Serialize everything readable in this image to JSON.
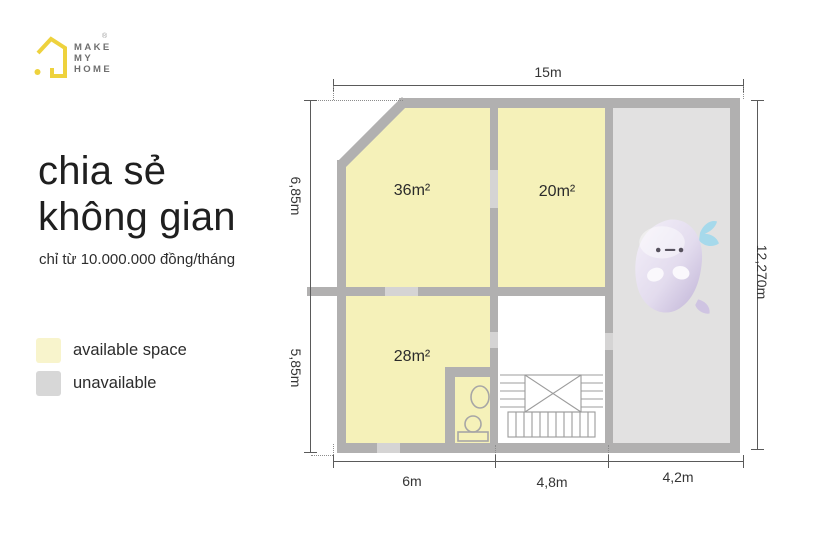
{
  "logo": {
    "lines": [
      "MAKE",
      "MY",
      "HOME"
    ],
    "registered": "®",
    "brand_yellow": "#eed23d"
  },
  "headline": {
    "line1": "chia sẻ",
    "line2": "không gian",
    "subtitle": "chỉ từ 10.000.000 đồng/tháng"
  },
  "legend": {
    "items": [
      {
        "label": "available space",
        "color": "#f8f4cc"
      },
      {
        "label": "unavailable",
        "color": "#d7d7d7"
      }
    ]
  },
  "floorplan": {
    "rooms": [
      {
        "id": "room-36",
        "area_label": "36m²",
        "status": "available"
      },
      {
        "id": "room-20",
        "area_label": "20m²",
        "status": "available"
      },
      {
        "id": "room-28",
        "area_label": "28m²",
        "status": "available"
      }
    ],
    "dimensions": {
      "top": "15m",
      "right": "12,270m",
      "left_upper": "6,85m",
      "left_lower": "5,85m",
      "bottom": [
        "6m",
        "4,8m",
        "4,2m"
      ]
    },
    "colors": {
      "available_fill": "#f5f1b9",
      "unavailable_fill": "#e2e1e1",
      "wall": "#b1b0b0"
    }
  }
}
